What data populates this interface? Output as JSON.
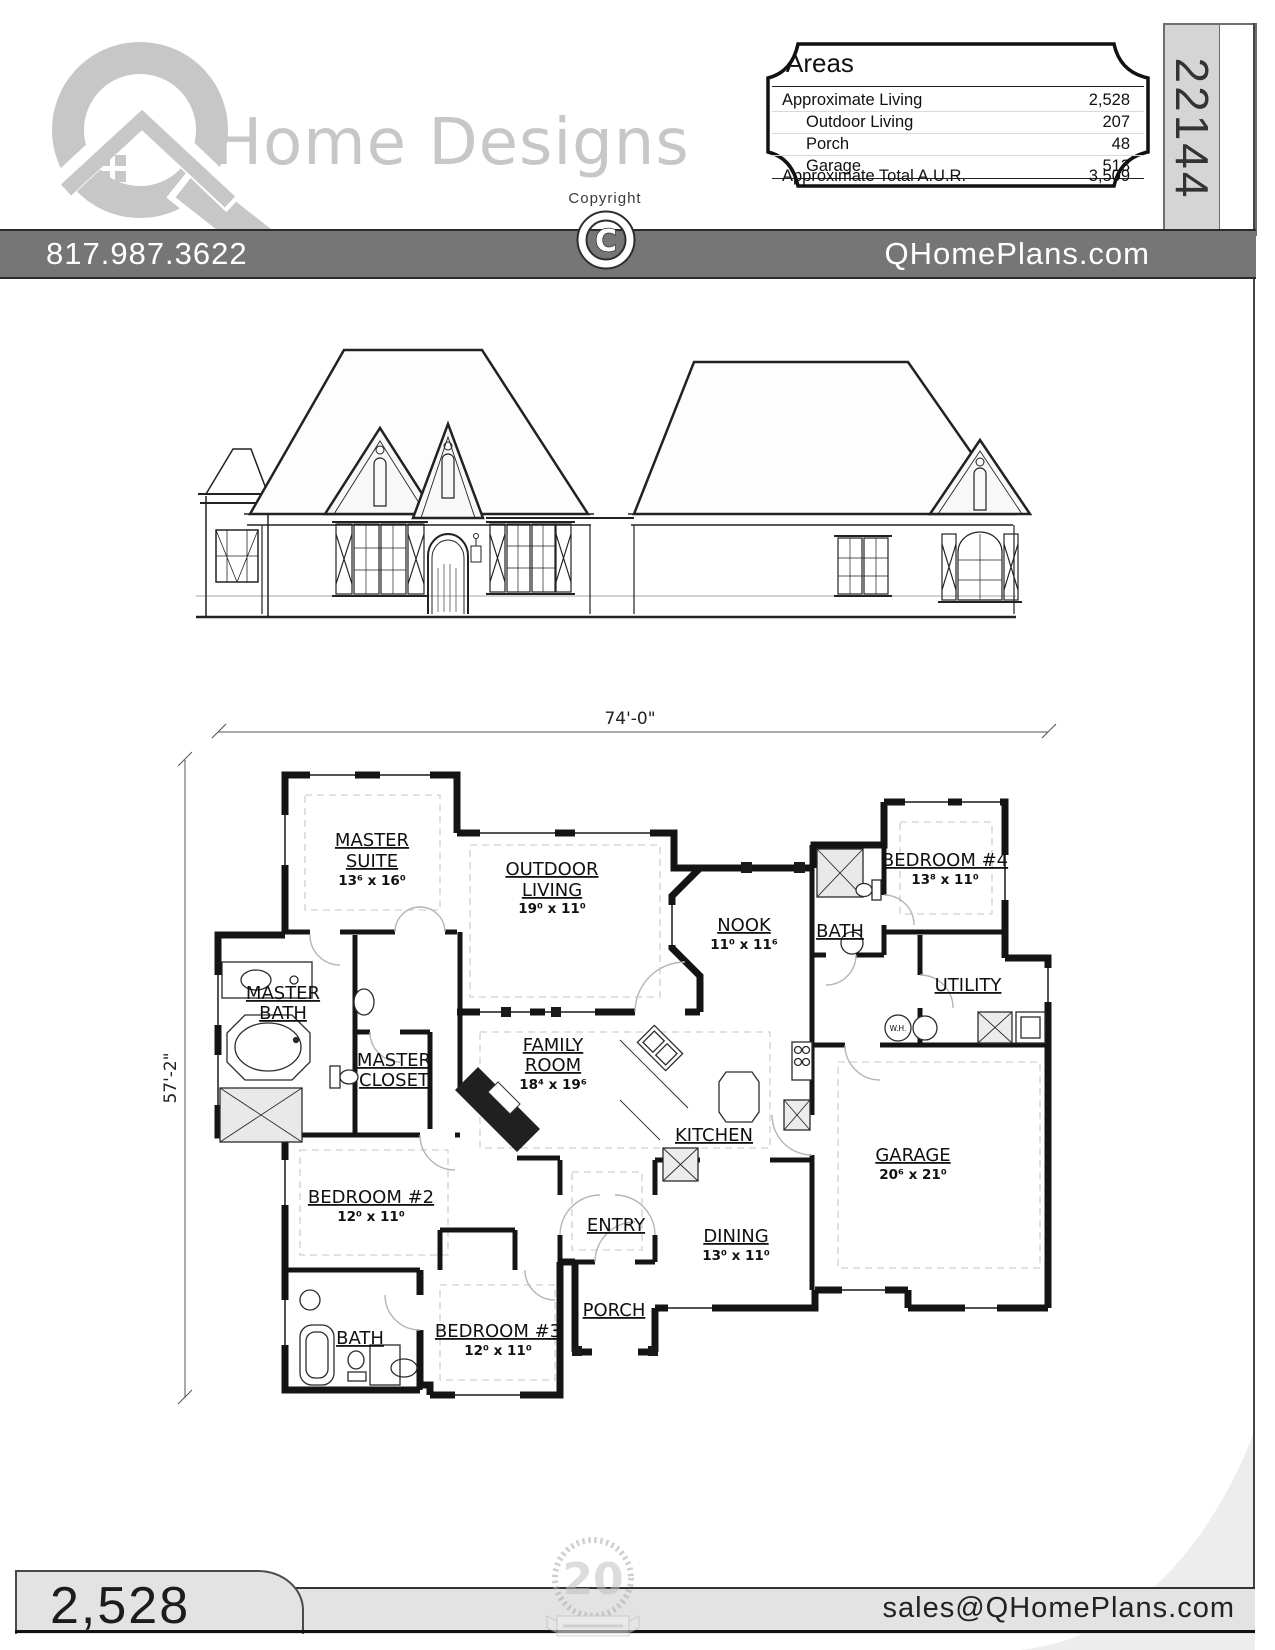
{
  "header": {
    "logo": {
      "brand_text": "Home Designs"
    },
    "copyright_label": "Copyright",
    "copyright_symbol": "C",
    "areas_panel": {
      "title": "Areas",
      "rows": [
        {
          "label": "Approximate Living",
          "value": "2,528"
        },
        {
          "label": "Outdoor Living",
          "value": "207"
        },
        {
          "label": "Porch",
          "value": "48"
        },
        {
          "label": "Garage",
          "value": "513"
        },
        {
          "label": "Approximate Total A.U.R.",
          "value": "3,509"
        }
      ]
    },
    "plan_number": "22144"
  },
  "contact_bar": {
    "phone": "817.987.3622",
    "website": "QHomePlans.com"
  },
  "floor_plan": {
    "dimensions": {
      "width_label": "74'-0\"",
      "height_label": "57'-2\""
    },
    "rooms": [
      {
        "line1": "MASTER",
        "line2": "SUITE",
        "size": "13⁶ x 16⁰"
      },
      {
        "line1": "OUTDOOR",
        "line2": "LIVING",
        "size": "19⁰ x 11⁰"
      },
      {
        "line1": "NOOK",
        "size": "11⁰ x 11⁶"
      },
      {
        "line1": "BATH"
      },
      {
        "line1": "BEDROOM #4",
        "size": "13⁸ x 11⁰"
      },
      {
        "line1": "UTILITY"
      },
      {
        "line1": "MASTER",
        "line2": "BATH"
      },
      {
        "line1": "MASTER",
        "line2": "CLOSET"
      },
      {
        "line1": "FAMILY",
        "line2": "ROOM",
        "size": "18⁴ x 19⁶"
      },
      {
        "line1": "KITCHEN"
      },
      {
        "line1": "GARAGE",
        "size": "20⁶ x 21⁰"
      },
      {
        "line1": "BEDROOM #2",
        "size": "12⁰ x 11⁰"
      },
      {
        "line1": "ENTRY"
      },
      {
        "line1": "DINING",
        "size": "13⁰ x 11⁰"
      },
      {
        "line1": "BATH"
      },
      {
        "line1": "BEDROOM #3",
        "size": "12⁰ x 11⁰"
      },
      {
        "line1": "PORCH"
      },
      {
        "line1": "W.H."
      }
    ]
  },
  "footer": {
    "living_area": "2,528",
    "email": "sales@QHomePlans.com",
    "badge_number": "20"
  }
}
